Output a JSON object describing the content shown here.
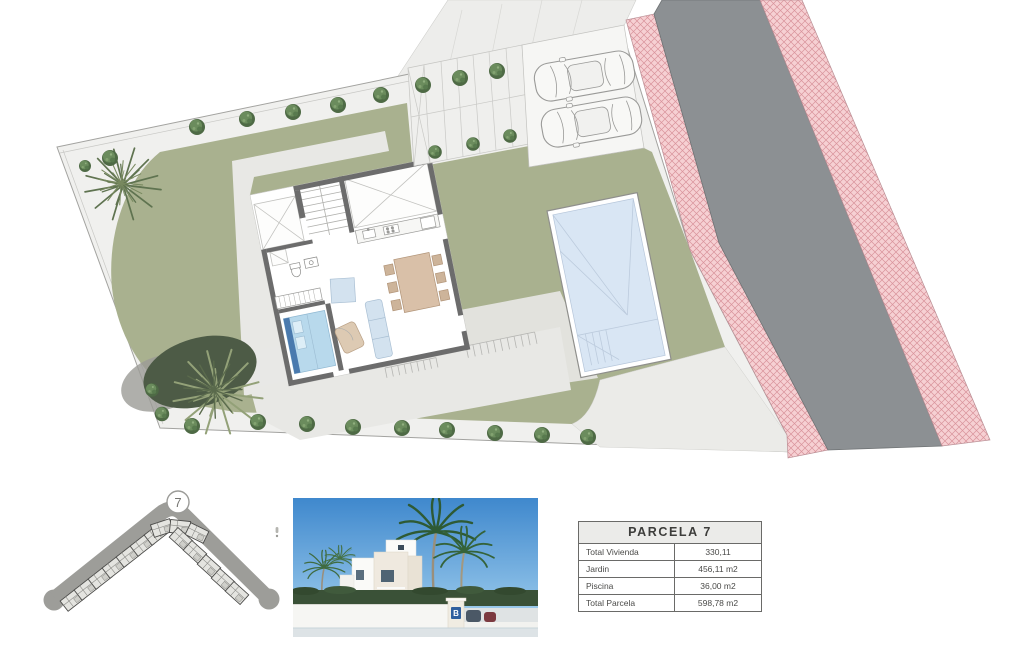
{
  "parcel_table": {
    "title": "PARCELA 7",
    "rows": [
      {
        "label": "Total Vivienda",
        "value": "330,11"
      },
      {
        "label": "Jardin",
        "value": "456,11 m2"
      },
      {
        "label": "Piscina",
        "value": "36,00 m2"
      },
      {
        "label": "Total Parcela",
        "value": "598,78 m2"
      }
    ]
  },
  "locator": {
    "lot_number": "7"
  },
  "villa_photo": {
    "logo_letter": "B"
  },
  "colors": {
    "lawn": "#a9b18f",
    "plot_path": "#f0f0ee",
    "terrace": "#e8e8e5",
    "road_asphalt": "#8c9093",
    "sidewalk_pink": "#f6d0d3",
    "pool_water": "#d9e6f4",
    "wall_gray": "#6c6c6c"
  }
}
